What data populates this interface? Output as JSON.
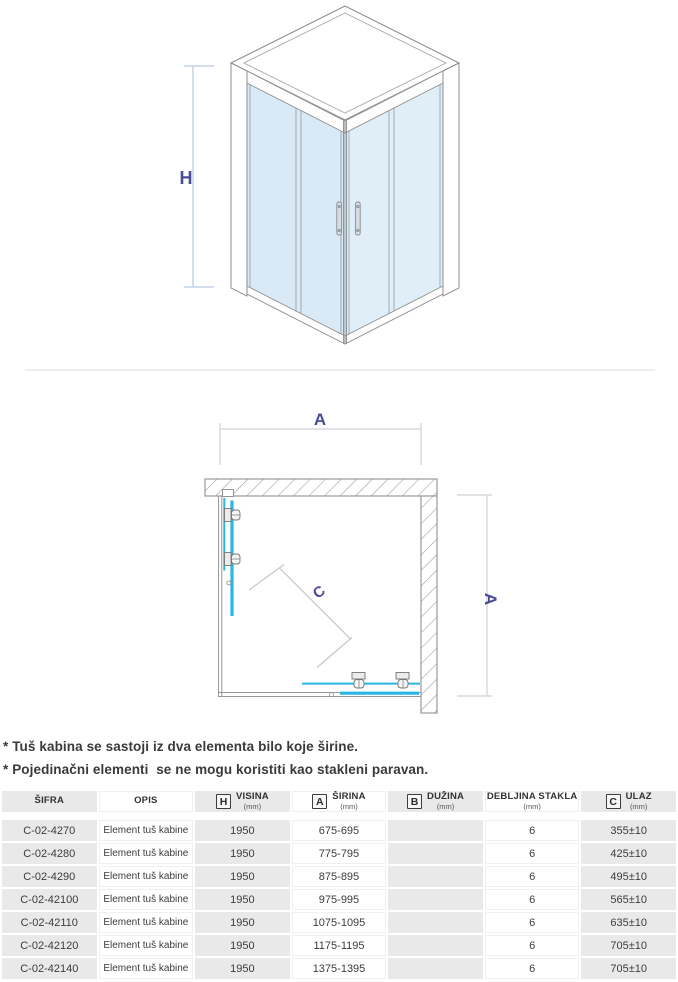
{
  "diagram_iso": {
    "height_label": "H"
  },
  "diagram_top": {
    "width_label": "A",
    "depth_label": "A",
    "entry_label": "C"
  },
  "notes": [
    "* Tuš kabina se sastoji iz dva elementa bilo koje širine.",
    "* Pojedinačni elementi  se ne mogu koristiti kao stakleni paravan."
  ],
  "table": {
    "columns": [
      {
        "label": "ŠIFRA",
        "sub": "",
        "letter": ""
      },
      {
        "label": "OPIS",
        "sub": "",
        "letter": ""
      },
      {
        "label": "VISINA",
        "sub": "(mm)",
        "letter": "H"
      },
      {
        "label": "ŠIRINA",
        "sub": "(mm)",
        "letter": "A"
      },
      {
        "label": "DUŽINA",
        "sub": "(mm)",
        "letter": "B"
      },
      {
        "label": "DEBLJINA STAKLA",
        "sub": "(mm)",
        "letter": ""
      },
      {
        "label": "ULAZ",
        "sub": "(mm)",
        "letter": "C"
      }
    ],
    "rows": [
      [
        "C-02-4270",
        "Element tuš kabine",
        "1950",
        "675-695",
        "",
        "6",
        "355±10"
      ],
      [
        "C-02-4280",
        "Element tuš kabine",
        "1950",
        "775-795",
        "",
        "6",
        "425±10"
      ],
      [
        "C-02-4290",
        "Element tuš kabine",
        "1950",
        "875-895",
        "",
        "6",
        "495±10"
      ],
      [
        "C-02-42100",
        "Element tuš kabine",
        "1950",
        "975-995",
        "",
        "6",
        "565±10"
      ],
      [
        "C-02-42110",
        "Element tuš kabine",
        "1950",
        "1075-1095",
        "",
        "6",
        "635±10"
      ],
      [
        "C-02-42120",
        "Element tuš kabine",
        "1950",
        "1175-1195",
        "",
        "6",
        "705±10"
      ],
      [
        "C-02-42140",
        "Element tuš kabine",
        "1950",
        "1375-1395",
        "",
        "6",
        "705±10"
      ]
    ]
  },
  "colors": {
    "glass_cyan": "#29b6e3",
    "glass_blue": "#d9eaf6",
    "label_indigo": "#4a4a99",
    "table_gray": "#e9e9e9",
    "dim_line_blue": "#c3d3e6",
    "outline_gray": "#8f8f8f"
  }
}
